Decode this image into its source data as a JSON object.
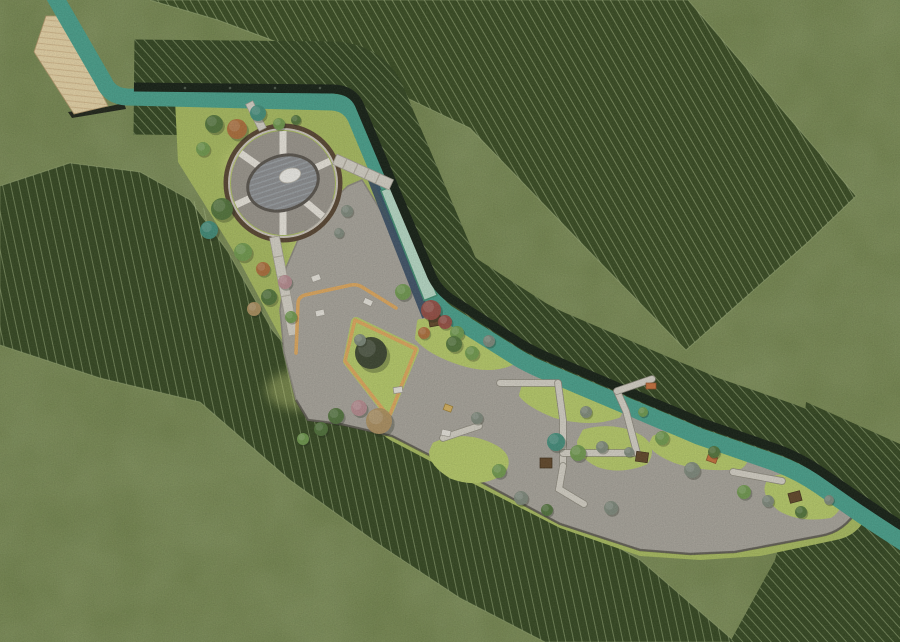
{
  "canvas": {
    "width": 900,
    "height": 642
  },
  "palette": {
    "grass_base": "#6d8046",
    "grass_mottle_dark": "#4e6030",
    "grass_mottle_light": "#8ba05c",
    "slope_dark_tr": "#35491e",
    "slope_dark_b": "#31451d",
    "slope_hatch_line": "#cfe0a8",
    "lawn": "#a9bd5e",
    "lawn_bright": "#b8cd68",
    "lawn_patch_light": "#d6e082",
    "plaza": "#a9a59c",
    "plaza_edge": "#56524a",
    "stream": "#46a18c",
    "stream_shadow_blue": "#344a63",
    "pool": "#b9ddc9",
    "pool_edge": "#3f8f72",
    "wall": "#101b10",
    "deck": "#e9d6a8",
    "deck_line": "#d2b687",
    "circle_rim_brown": "#55422e",
    "circle_ring_gray": "#9b968d",
    "circle_spoke_white": "#ece8df",
    "circle_inner_gray": "#8b8d90",
    "circle_inner_stripe": "#9ba1a6",
    "sculpture_white": "#f2f1ec",
    "path_light": "#d7d3c8",
    "yellow_path": "#e2a95c",
    "bench_white": "#e9e6de",
    "bench_brown": "#5f4426",
    "bench_orange": "#c9703a",
    "duck_yellow": "#d9b35e"
  },
  "circle_plaza": {
    "cx": 283,
    "cy": 183,
    "outer_r": 57,
    "ring_r": 52,
    "spoke_angles_deg": [
      -90,
      -25,
      40,
      90,
      155,
      215
    ]
  },
  "trees": [
    {
      "x": 214,
      "y": 124,
      "r": 9,
      "c": "#4e7238"
    },
    {
      "x": 237,
      "y": 129,
      "r": 10,
      "c": "#b06b38"
    },
    {
      "x": 258,
      "y": 113,
      "r": 8,
      "c": "#3e8e7b"
    },
    {
      "x": 279,
      "y": 124,
      "r": 6,
      "c": "#6f9b4c"
    },
    {
      "x": 203,
      "y": 149,
      "r": 7,
      "c": "#6f9b4c"
    },
    {
      "x": 296,
      "y": 120,
      "r": 5,
      "c": "#4e7238"
    },
    {
      "x": 222,
      "y": 209,
      "r": 11,
      "c": "#4e7238"
    },
    {
      "x": 209,
      "y": 230,
      "r": 9,
      "c": "#3e8e7b"
    },
    {
      "x": 243,
      "y": 252,
      "r": 9,
      "c": "#6f9b4c"
    },
    {
      "x": 263,
      "y": 269,
      "r": 7,
      "c": "#b06b38"
    },
    {
      "x": 285,
      "y": 282,
      "r": 7,
      "c": "#b98b90"
    },
    {
      "x": 269,
      "y": 297,
      "r": 8,
      "c": "#4e7238"
    },
    {
      "x": 254,
      "y": 309,
      "r": 7,
      "c": "#b0915f"
    },
    {
      "x": 291,
      "y": 317,
      "r": 6,
      "c": "#6f9b4c"
    },
    {
      "x": 347,
      "y": 211,
      "r": 6,
      "c": "#7e8a7c"
    },
    {
      "x": 339,
      "y": 233,
      "r": 5,
      "c": "#7e8a7c"
    },
    {
      "x": 403,
      "y": 292,
      "r": 8,
      "c": "#6f9b4c"
    },
    {
      "x": 431,
      "y": 310,
      "r": 10,
      "c": "#984a40"
    },
    {
      "x": 445,
      "y": 322,
      "r": 7,
      "c": "#984a40"
    },
    {
      "x": 457,
      "y": 333,
      "r": 7,
      "c": "#6f9b4c"
    },
    {
      "x": 424,
      "y": 333,
      "r": 6,
      "c": "#b06b38"
    },
    {
      "x": 454,
      "y": 344,
      "r": 8,
      "c": "#4e7238"
    },
    {
      "x": 472,
      "y": 353,
      "r": 7,
      "c": "#6f9b4c"
    },
    {
      "x": 489,
      "y": 341,
      "r": 6,
      "c": "#7e8a7c"
    },
    {
      "x": 371,
      "y": 353,
      "r": 16,
      "c": "#343d2b"
    },
    {
      "x": 360,
      "y": 340,
      "r": 6,
      "c": "#7e8a7c"
    },
    {
      "x": 379,
      "y": 421,
      "r": 13,
      "c": "#b0915f"
    },
    {
      "x": 359,
      "y": 408,
      "r": 8,
      "c": "#b98b90"
    },
    {
      "x": 336,
      "y": 416,
      "r": 8,
      "c": "#4e7238"
    },
    {
      "x": 321,
      "y": 429,
      "r": 7,
      "c": "#4e7238"
    },
    {
      "x": 303,
      "y": 439,
      "r": 6,
      "c": "#6f9b4c"
    },
    {
      "x": 477,
      "y": 418,
      "r": 6,
      "c": "#7e8a7c"
    },
    {
      "x": 556,
      "y": 442,
      "r": 9,
      "c": "#3e8e7b"
    },
    {
      "x": 578,
      "y": 453,
      "r": 8,
      "c": "#6f9b4c"
    },
    {
      "x": 602,
      "y": 447,
      "r": 6,
      "c": "#7e8a7c"
    },
    {
      "x": 629,
      "y": 452,
      "r": 5,
      "c": "#7e8a7c"
    },
    {
      "x": 499,
      "y": 471,
      "r": 7,
      "c": "#6f9b4c"
    },
    {
      "x": 521,
      "y": 498,
      "r": 7,
      "c": "#7e8a7c"
    },
    {
      "x": 547,
      "y": 510,
      "r": 6,
      "c": "#4e7238"
    },
    {
      "x": 611,
      "y": 508,
      "r": 7,
      "c": "#7e8a7c"
    },
    {
      "x": 662,
      "y": 438,
      "r": 7,
      "c": "#6f9b4c"
    },
    {
      "x": 692,
      "y": 470,
      "r": 8,
      "c": "#7e8a7c"
    },
    {
      "x": 714,
      "y": 452,
      "r": 6,
      "c": "#4e7238"
    },
    {
      "x": 744,
      "y": 492,
      "r": 7,
      "c": "#6f9b4c"
    },
    {
      "x": 768,
      "y": 501,
      "r": 6,
      "c": "#7e8a7c"
    },
    {
      "x": 801,
      "y": 512,
      "r": 6,
      "c": "#4e7238"
    },
    {
      "x": 829,
      "y": 500,
      "r": 5,
      "c": "#7e8a7c"
    },
    {
      "x": 586,
      "y": 412,
      "r": 6,
      "c": "#7e8a7c"
    },
    {
      "x": 643,
      "y": 412,
      "r": 5,
      "c": "#6f9b4c"
    }
  ],
  "benches_white": [
    [
      316,
      278,
      -20
    ],
    [
      320,
      313,
      -12
    ],
    [
      368,
      302,
      25
    ],
    [
      398,
      390,
      -8
    ],
    [
      446,
      433,
      12
    ]
  ],
  "benches_brown": [
    [
      435,
      321,
      -10
    ],
    [
      546,
      463,
      0
    ],
    [
      642,
      457,
      8
    ],
    [
      795,
      497,
      -15
    ]
  ],
  "benches_orange": [
    [
      712,
      459,
      20
    ],
    [
      651,
      386,
      0
    ]
  ],
  "duck": [
    448,
    408,
    20
  ],
  "plaza_paths": [
    "M500,383 L558,383",
    "M558,383 L563,420 L563,466",
    "M563,453 L637,453",
    "M637,453 L626,411 L617,391",
    "M563,466 L559,489 L584,504",
    "M443,438 L479,426",
    "M733,472 L782,481",
    "M617,391 L652,379"
  ],
  "wall_dots_x": [
    185,
    230,
    275,
    320
  ],
  "wall_dots_y": 88
}
